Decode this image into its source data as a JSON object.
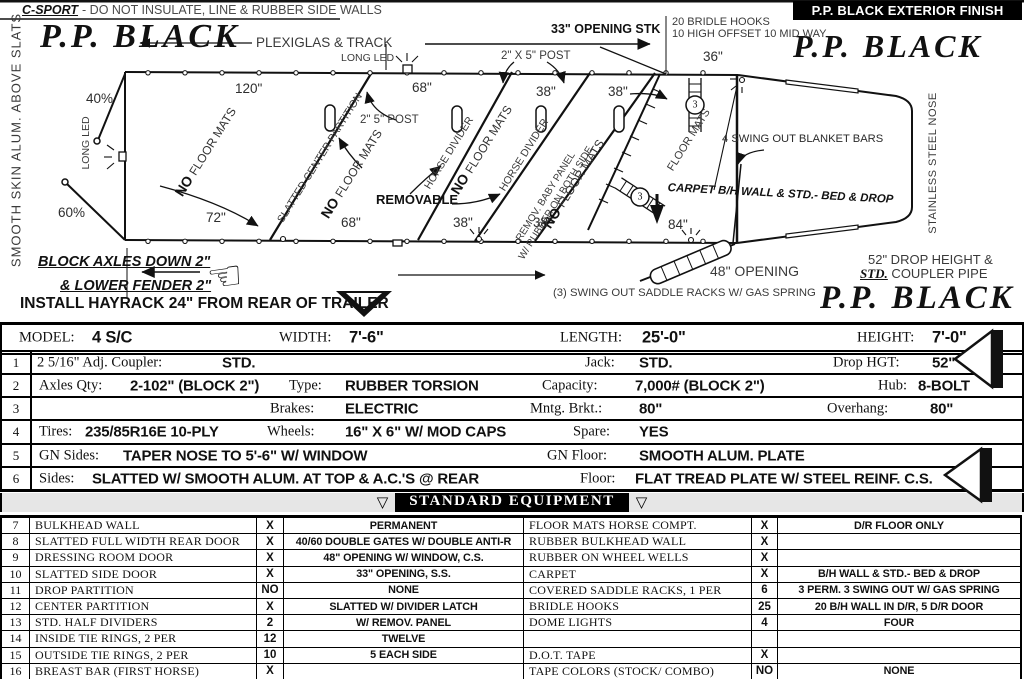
{
  "colors": {
    "ink": "#111111",
    "muted": "#3a3a3a",
    "band_bg": "#e6e6e6"
  },
  "icons": {
    "hand_left": "☜",
    "triangle_down": "▽"
  },
  "header": {
    "model_code": "C-SPORT",
    "note": "- DO NOT INSULATE, LINE & RUBBER SIDE WALLS",
    "finish_banner": "P.P. BLACK EXTERIOR FINISH"
  },
  "paint": {
    "script": "P.P. BLACK"
  },
  "diagram": {
    "left_wall_note": "SMOOTH SKIN ALUM. ABOVE SLATS",
    "nose_note": "STAINLESS STEEL NOSE",
    "plexiglas_track": "PLEXIGLAS & TRACK",
    "long_led": "LONG LED",
    "opening_stk": "33\" OPENING STK",
    "bridle_hooks_1": "20 BRIDLE HOOKS",
    "bridle_hooks_2": "10 HIGH OFFSET 10 MID WAY",
    "post_top": "2\" X 5\" POST",
    "post_mid": "2\" 5\" POST",
    "pct_top": "40%",
    "pct_bottom": "60%",
    "dim_120": "120\"",
    "dim_68_top": "68\"",
    "dim_38a_top": "38\"",
    "dim_38b_top": "38\"",
    "dim_36": "36\"",
    "dim_72": "72\"",
    "dim_68_bot": "68\"",
    "dim_38a_bot": "38\"",
    "dim_38b_bot": "38\"",
    "dim_84": "84\"",
    "no_label": "NO",
    "floor_mats_label": "FLOOR MATS",
    "slatted_center_partition": "SLATTED CENTER PARTITION",
    "horse_divider": "HORSE DIVIDER",
    "removable": "REMOVABLE",
    "baby_panel_1": "REMOV. BABY PANEL",
    "baby_panel_2": "W/ RUBBER ON BOTH SIDE",
    "floor_mats_note": "FLOOR MATS",
    "rack_count": "3",
    "blanket_bars": "4 SWING OUT BLANKET BARS",
    "carpet_note": "CARPET B/H WALL & STD.- BED & DROP",
    "opening_48": "48\" OPENING",
    "saddle_racks_note": "(3) SWING OUT SADDLE RACKS W/ GAS SPRING",
    "drop_height_1": "52\" DROP HEIGHT &",
    "drop_height_std": "STD.",
    "drop_height_2": " COUPLER PIPE",
    "block_axles_1": "BLOCK AXLES DOWN 2\"",
    "block_axles_2": "& LOWER FENDER 2\"",
    "hayrack_note": "INSTALL HAYRACK 24\" FROM REAR OF TRAILER"
  },
  "specs": {
    "header": {
      "model_label": "MODEL:",
      "model": "4 S/C",
      "width_label": "WIDTH:",
      "width": "7'-6\"",
      "length_label": "LENGTH:",
      "length": "25'-0\"",
      "height_label": "HEIGHT:",
      "height": "7'-0\""
    },
    "rows": [
      {
        "num": "1",
        "cells": [
          {
            "label": "2 5/16\" Adj. Coupler:",
            "value": "STD."
          },
          {
            "label": "Jack:",
            "value": "STD."
          },
          {
            "label": "Drop HGT:",
            "value": "52\""
          }
        ]
      },
      {
        "num": "2",
        "cells": [
          {
            "label": "Axles Qty:",
            "value": "2-102\" (BLOCK 2\")"
          },
          {
            "label": "Type:",
            "value": "RUBBER TORSION"
          },
          {
            "label": "Capacity:",
            "value": "7,000# (BLOCK 2\")"
          },
          {
            "label": "Hub:",
            "value": "8-BOLT"
          }
        ]
      },
      {
        "num": "3",
        "cells": [
          {
            "label": "Brakes:",
            "value": "ELECTRIC"
          },
          {
            "label": "Mntg. Brkt.:",
            "value": "80\""
          },
          {
            "label": "Overhang:",
            "value": "80\""
          }
        ]
      },
      {
        "num": "4",
        "cells": [
          {
            "label": "Tires:",
            "value": "235/85R16E 10-PLY"
          },
          {
            "label": "Wheels:",
            "value": "16\" X 6\" W/ MOD CAPS"
          },
          {
            "label": "Spare:",
            "value": "YES"
          }
        ]
      },
      {
        "num": "5",
        "cells": [
          {
            "label": "GN Sides:",
            "value": "TAPER NOSE TO 5'-6\" W/ WINDOW"
          },
          {
            "label": "GN Floor:",
            "value": "SMOOTH ALUM. PLATE"
          }
        ]
      },
      {
        "num": "6",
        "cells": [
          {
            "label": "Sides:",
            "value": "SLATTED W/ SMOOTH ALUM. AT TOP & A.C.'S @ REAR"
          },
          {
            "label": "Floor:",
            "value": "FLAT TREAD PLATE W/ STEEL REINF. C.S."
          }
        ]
      }
    ]
  },
  "equipment": {
    "title": "STANDARD EQUIPMENT",
    "rows": [
      {
        "num": "7",
        "item": "BULKHEAD WALL",
        "qty": "X",
        "desc": "PERMANENT",
        "item2": "FLOOR MATS HORSE COMPT.",
        "qty2": "X",
        "desc2": "D/R FLOOR ONLY"
      },
      {
        "num": "8",
        "item": "SLATTED FULL WIDTH REAR DOOR",
        "qty": "X",
        "desc": "40/60 DOUBLE GATES W/ DOUBLE ANTI-R",
        "item2": "RUBBER BULKHEAD WALL",
        "qty2": "X",
        "desc2": ""
      },
      {
        "num": "9",
        "item": "DRESSING ROOM DOOR",
        "qty": "X",
        "desc": "48\" OPENING W/ WINDOW, C.S.",
        "item2": "RUBBER ON WHEEL WELLS",
        "qty2": "X",
        "desc2": ""
      },
      {
        "num": "10",
        "item": "SLATTED SIDE DOOR",
        "qty": "X",
        "desc": "33\" OPENING, S.S.",
        "item2": "CARPET",
        "qty2": "X",
        "desc2": "B/H WALL & STD.- BED & DROP"
      },
      {
        "num": "11",
        "item": "DROP PARTITION",
        "qty": "NO",
        "desc": "NONE",
        "item2": "COVERED SADDLE RACKS, 1 PER",
        "qty2": "6",
        "desc2": "3 PERM. 3 SWING OUT W/ GAS SPRING"
      },
      {
        "num": "12",
        "item": "CENTER PARTITION",
        "qty": "X",
        "desc": "SLATTED W/ DIVIDER LATCH",
        "item2": "BRIDLE HOOKS",
        "qty2": "25",
        "desc2": "20 B/H WALL IN D/R, 5 D/R DOOR"
      },
      {
        "num": "13",
        "item": "STD. HALF DIVIDERS",
        "qty": "2",
        "desc": "W/ REMOV. PANEL",
        "item2": "DOME LIGHTS",
        "qty2": "4",
        "desc2": "FOUR"
      },
      {
        "num": "14",
        "item": "INSIDE TIE RINGS, 2 PER",
        "qty": "12",
        "desc": "TWELVE",
        "item2": "",
        "qty2": "",
        "desc2": ""
      },
      {
        "num": "15",
        "item": "OUTSIDE TIE RINGS, 2 PER",
        "qty": "10",
        "desc": "5 EACH SIDE",
        "item2": "D.O.T. TAPE",
        "qty2": "X",
        "desc2": ""
      },
      {
        "num": "16",
        "item": "BREAST BAR (FIRST HORSE)",
        "qty": "X",
        "desc": "",
        "item2": "TAPE COLORS (STOCK/ COMBO)",
        "qty2": "NO",
        "desc2": "NONE"
      }
    ]
  }
}
